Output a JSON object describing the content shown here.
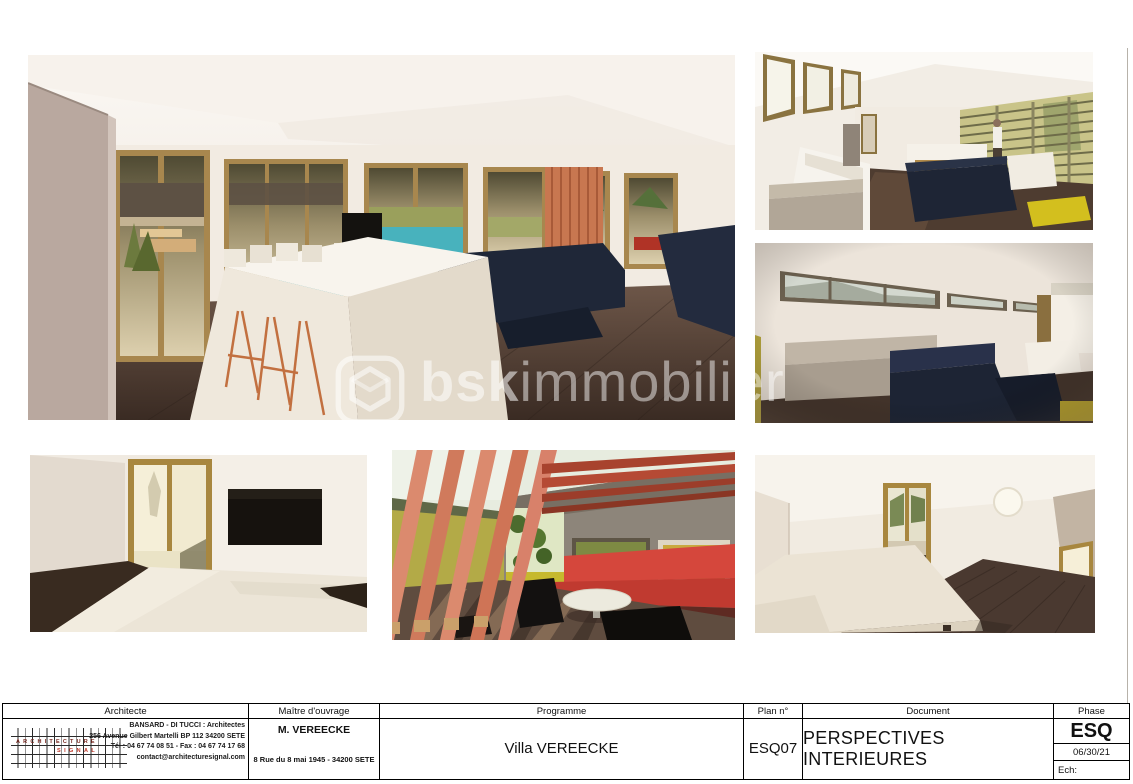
{
  "sheet": {
    "background": "#ffffff",
    "border_color": "#000000"
  },
  "watermark": {
    "logo_name": "bsk-hexagon-logo",
    "text_bold": "bsk",
    "text_light": "immobilier",
    "color": "#ffffff"
  },
  "renders": {
    "main": "living-dining-room-with-pool-view",
    "top_right": "mezzanine-lounge-louvered-windows",
    "mid_right": "lounge-clerestory-strip-windows",
    "bottom_left": "bedroom-with-tv",
    "bottom_middle": "covered-terrace-red-pergola",
    "bottom_right": "bedroom-porthole-window"
  },
  "title_block": {
    "headers": {
      "architect": "Architecte",
      "client": "Maître d'ouvrage",
      "programme": "Programme",
      "plan_no": "Plan n°",
      "document": "Document",
      "phase": "Phase"
    },
    "architect": {
      "logo_word_top": "ARCHITECTURE",
      "logo_word_bottom": "SIGNAL",
      "logo_color": "#c0392b",
      "line1": "BANSARD - DI TUCCI : Architectes",
      "line2": "256 Avenue Gilbert Martelli BP 112 34200 SETE",
      "line3": "Tél : 04 67 74 08 51 - Fax : 04 67 74 17 68",
      "line4": "contact@architecturesignal.com"
    },
    "client": {
      "name": "M. VEREECKE",
      "address": "8 Rue du 8 mai 1945 - 34200 SETE"
    },
    "programme": "Villa VEREECKE",
    "plan_no": "ESQ07",
    "document": "PERSPECTIVES INTERIEURES",
    "phase": {
      "code": "ESQ",
      "date": "06/30/21",
      "scale_label": "Ech:"
    }
  }
}
